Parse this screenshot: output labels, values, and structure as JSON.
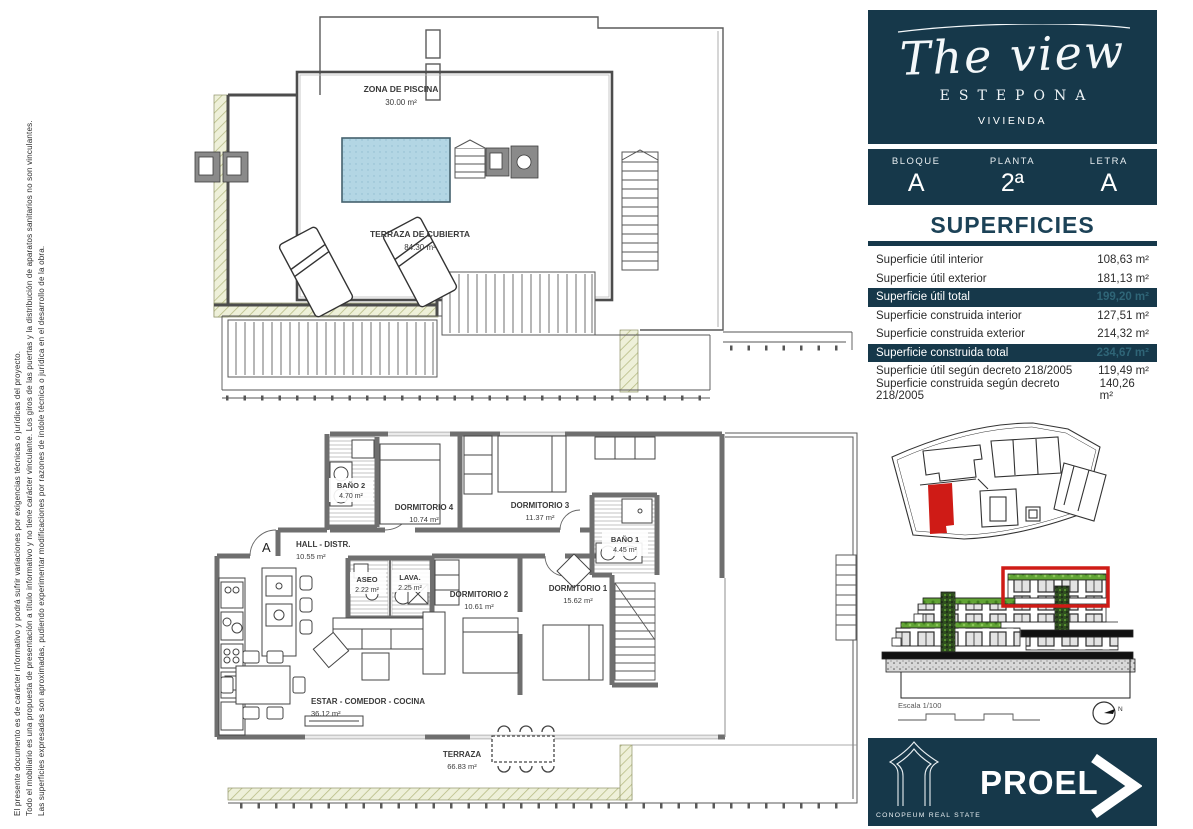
{
  "disclaimer": {
    "lines": [
      "El presente documento es de carácter informativo y podrá sufrir variaciones por exigencias técnicas o jurídicas del proyecto.",
      "Todo el mobiliario es una propuesta de presentación a título informativo y no tiene carácter vinculante. Los giros de las puertas y la distribución de aparatos sanitarios no son vinculantes.",
      "Las superficies expresadas son aproximadas, pudiendo experimentar modificaciones por razones de índole técnica o jurídica en el desarrollo de la obra."
    ]
  },
  "header": {
    "script_title": "The view",
    "city": "ESTEPONA",
    "dwelling_label": "VIVIENDA",
    "fields": [
      {
        "label": "BLOQUE",
        "value": "A"
      },
      {
        "label": "PLANTA",
        "value": "2ª"
      },
      {
        "label": "LETRA",
        "value": "A"
      }
    ]
  },
  "superficies": {
    "title": "SUPERFICIES",
    "rows": [
      {
        "label": "Superficie útil interior",
        "value": "108,63 m²",
        "highlight": false
      },
      {
        "label": "Superficie útil exterior",
        "value": "181,13 m²",
        "highlight": false
      },
      {
        "label": "Superficie útil total",
        "value": "199,20 m²",
        "highlight": true
      },
      {
        "label": "Superficie construida interior",
        "value": "127,51 m²",
        "highlight": false
      },
      {
        "label": "Superficie construida exterior",
        "value": "214,32 m²",
        "highlight": false
      },
      {
        "label": "Superficie construida total",
        "value": "234,67 m²",
        "highlight": true
      },
      {
        "label": "Superficie útil según decreto 218/2005",
        "value": "119,49 m²",
        "highlight": false
      },
      {
        "label": "Superficie construida según decreto 218/2005",
        "value": "140,26 m²",
        "highlight": false
      }
    ]
  },
  "plans": {
    "roof": {
      "zones": [
        {
          "name": "ZONA DE PISCINA",
          "area": "30.00 m²"
        },
        {
          "name": "TERRAZA DE CUBIERTA",
          "area": "84.30 m²"
        }
      ]
    },
    "apartment": {
      "entrance_letter": "A",
      "rooms": [
        {
          "name": "BAÑO 2",
          "area": "4.70 m²"
        },
        {
          "name": "DORMITORIO 4",
          "area": "10.74 m²"
        },
        {
          "name": "DORMITORIO 3",
          "area": "11.37 m²"
        },
        {
          "name": "BAÑO 1",
          "area": "4.45 m²"
        },
        {
          "name": "HALL - DISTR.",
          "area": "10.55 m²"
        },
        {
          "name": "ASEO",
          "area": "2.22 m²"
        },
        {
          "name": "LAVA.",
          "area": "2.25 m²"
        },
        {
          "name": "DORMITORIO 2",
          "area": "10.61 m²"
        },
        {
          "name": "DORMITORIO 1",
          "area": "15.62 m²"
        },
        {
          "name": "ESTAR - COMEDOR - COCINA",
          "area": "36.12 m²"
        },
        {
          "name": "TERRAZA",
          "area": "66.83 m²"
        }
      ]
    }
  },
  "elevation": {
    "scale_label": "Escala 1/100",
    "compass_label": "N"
  },
  "footer": {
    "brand": "PROEL",
    "subtitle": "CONOPEUM REAL STATE"
  },
  "colors": {
    "navy": "#16384a",
    "highlight_value": "#2f6577",
    "red": "#cf1b16",
    "plant_green": "#61a434",
    "pool_blue": "#b3d6e4",
    "hatch_olive": "#b8bd85"
  }
}
